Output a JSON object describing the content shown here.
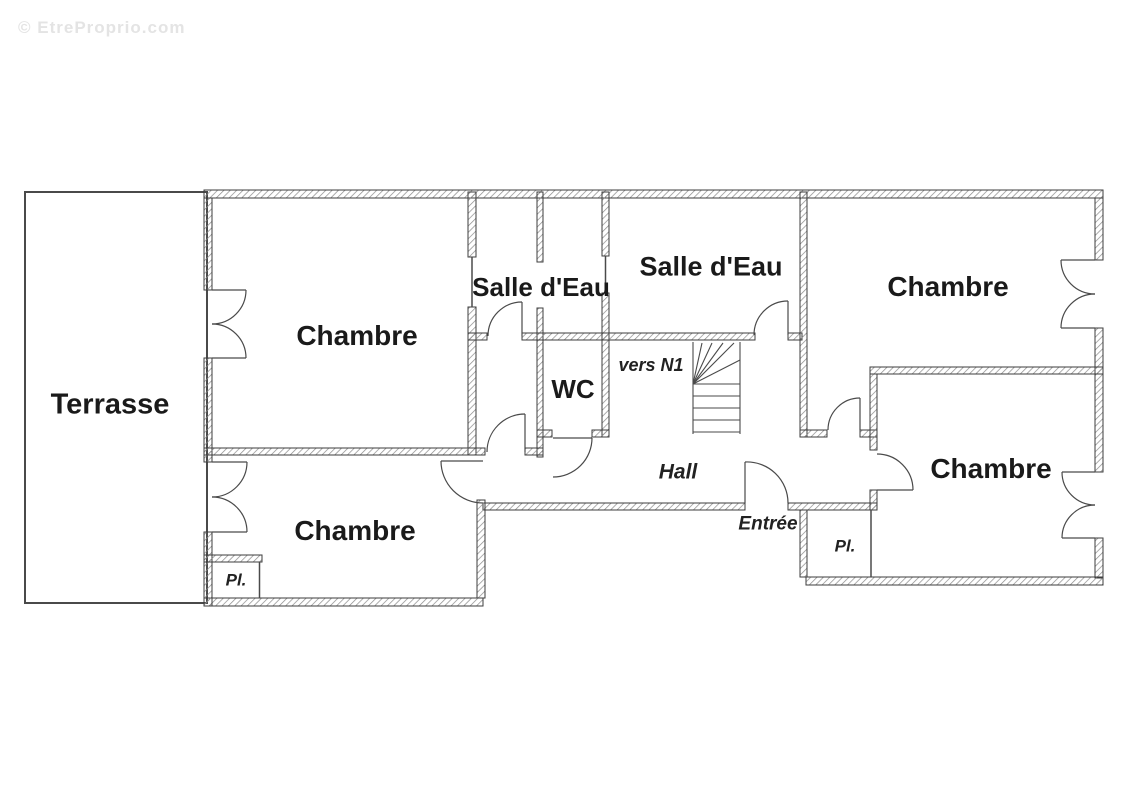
{
  "watermark": "© EtreProprio.com",
  "colors": {
    "wall_outline": "#3c3c3c",
    "hatch": "#8a8a8a",
    "text": "#1a1a1a",
    "door_lines": "#4a4a4a",
    "watermark": "#e4e4e4",
    "background": "#ffffff"
  },
  "floorplan": {
    "type": "apartment-floor-plan-level-0",
    "labels": [
      {
        "id": "terrasse",
        "text": "Terrasse"
      },
      {
        "id": "chambre-top-left",
        "text": "Chambre"
      },
      {
        "id": "salle-deau-left",
        "text": "Salle d'Eau"
      },
      {
        "id": "salle-deau-center",
        "text": "Salle d'Eau"
      },
      {
        "id": "chambre-top-right",
        "text": "Chambre"
      },
      {
        "id": "wc",
        "text": "WC"
      },
      {
        "id": "stairs-note",
        "text": "vers N1"
      },
      {
        "id": "hall",
        "text": "Hall"
      },
      {
        "id": "entree",
        "text": "Entrée"
      },
      {
        "id": "placard-right",
        "text": "Pl."
      },
      {
        "id": "chambre-bottom-left",
        "text": "Chambre"
      },
      {
        "id": "placard-left",
        "text": "Pl."
      },
      {
        "id": "chambre-bottom-right",
        "text": "Chambre"
      }
    ]
  }
}
